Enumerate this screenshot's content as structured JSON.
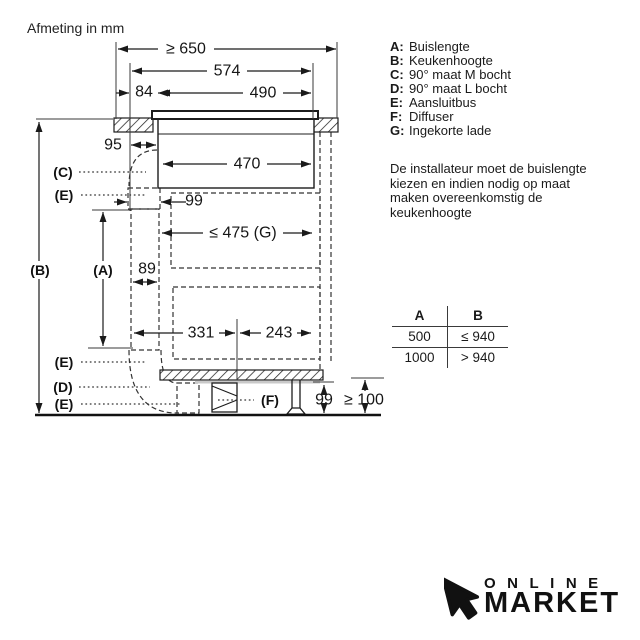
{
  "title": "Afmeting in mm",
  "legend": {
    "items": [
      {
        "key": "A:",
        "label": "Buislengte"
      },
      {
        "key": "B:",
        "label": "Keukenhoogte"
      },
      {
        "key": "C:",
        "label": "90° maat M bocht"
      },
      {
        "key": "D:",
        "label": "90° maat L bocht"
      },
      {
        "key": "E:",
        "label": "Aansluitbus"
      },
      {
        "key": "F:",
        "label": "Diffuser"
      },
      {
        "key": "G:",
        "label": "Ingekorte lade"
      }
    ]
  },
  "note": "De installateur moet de buislengte kiezen en indien nodig op maat maken overeenkomstig de keukenhoogte",
  "table": {
    "headers": [
      "A",
      "B"
    ],
    "rows": [
      [
        "500",
        "≤ 940"
      ],
      [
        "1000",
        "> 940"
      ]
    ]
  },
  "diagram": {
    "dims": {
      "w650": "≥ 650",
      "w574": "574",
      "w84": "84",
      "w490": "490",
      "w95": "95",
      "w470": "470",
      "d99top": "99",
      "d475": "≤ 475 (G)",
      "w89": "89",
      "d331": "331",
      "d243": "243",
      "h99": "99",
      "h100": "≥ 100"
    },
    "labels": {
      "a": "(A)",
      "b": "(B)",
      "c": "(C)",
      "d": "(D)",
      "e": "(E)",
      "f": "(F)"
    },
    "colors": {
      "duct_fill": "#d3d3d3",
      "line": "#1a1a1a"
    }
  },
  "logo": {
    "line1": "ONLINE",
    "line2": "MARKET"
  }
}
